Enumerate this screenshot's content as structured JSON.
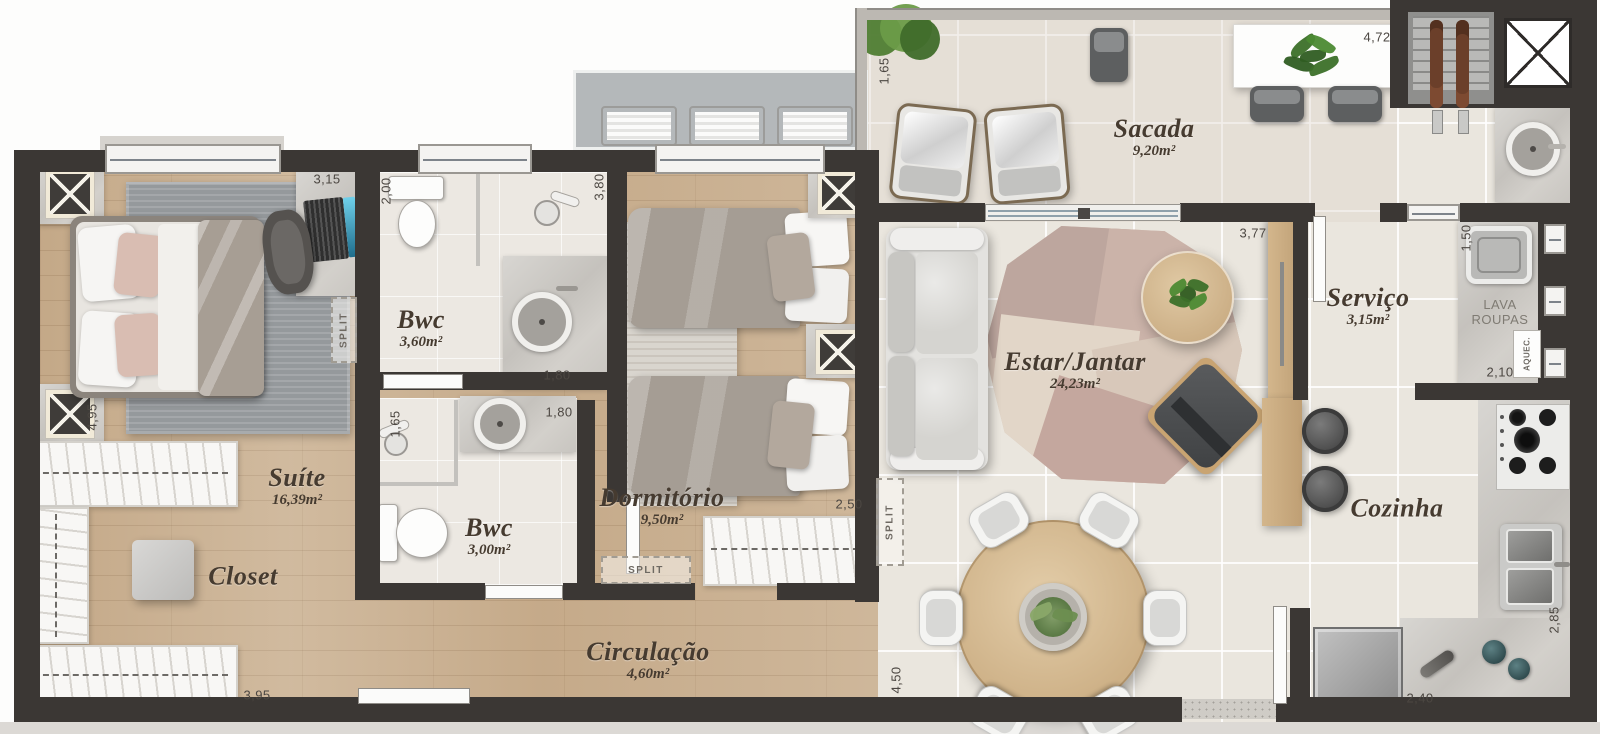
{
  "type": "floor_plan",
  "plan": {
    "rooms": [
      {
        "id": "suite",
        "name": "Suíte",
        "area": "16,39m²",
        "x": 297,
        "y": 487
      },
      {
        "id": "closet",
        "name": "Closet",
        "area": "",
        "x": 243,
        "y": 577
      },
      {
        "id": "bwc-suite",
        "name": "Bwc",
        "area": "3,60m²",
        "x": 421,
        "y": 329
      },
      {
        "id": "bwc-social",
        "name": "Bwc",
        "area": "3,00m²",
        "x": 489,
        "y": 537
      },
      {
        "id": "dormitorio",
        "name": "Dormitório",
        "area": "9,50m²",
        "x": 662,
        "y": 507
      },
      {
        "id": "circulacao",
        "name": "Circulação",
        "area": "4,60m²",
        "x": 648,
        "y": 661
      },
      {
        "id": "sacada",
        "name": "Sacada",
        "area": "9,20m²",
        "x": 1154,
        "y": 138
      },
      {
        "id": "estar-jantar",
        "name": "Estar/Jantar",
        "area": "24,23m²",
        "x": 1075,
        "y": 371
      },
      {
        "id": "servico",
        "name": "Serviço",
        "area": "3,15m²",
        "x": 1368,
        "y": 307
      },
      {
        "id": "cozinha",
        "name": "Cozinha",
        "area": "",
        "x": 1397,
        "y": 509
      }
    ],
    "dimensions": [
      {
        "text": "3,15",
        "x": 327,
        "y": 179,
        "rot": 0
      },
      {
        "text": "2,00",
        "x": 386,
        "y": 191,
        "rot": -90
      },
      {
        "text": "3,80",
        "x": 599,
        "y": 187,
        "rot": -90
      },
      {
        "text": "1,65",
        "x": 884,
        "y": 71,
        "rot": -90
      },
      {
        "text": "4,72",
        "x": 1377,
        "y": 37,
        "rot": 0
      },
      {
        "text": "4,95",
        "x": 92,
        "y": 417,
        "rot": -90
      },
      {
        "text": "3,95",
        "x": 257,
        "y": 695,
        "rot": 0
      },
      {
        "text": "1,80",
        "x": 557,
        "y": 375,
        "rot": 0
      },
      {
        "text": "1,65",
        "x": 395,
        "y": 424,
        "rot": -90
      },
      {
        "text": "1,80",
        "x": 559,
        "y": 412,
        "rot": 0
      },
      {
        "text": "2,50",
        "x": 849,
        "y": 504,
        "rot": 0
      },
      {
        "text": "3,77",
        "x": 1253,
        "y": 233,
        "rot": 0
      },
      {
        "text": "1,50",
        "x": 1466,
        "y": 238,
        "rot": -90
      },
      {
        "text": "2,10",
        "x": 1500,
        "y": 372,
        "rot": 0
      },
      {
        "text": "2,85",
        "x": 1554,
        "y": 620,
        "rot": -90
      },
      {
        "text": "2,40",
        "x": 1420,
        "y": 698,
        "rot": 0
      },
      {
        "text": "4,50",
        "x": 896,
        "y": 680,
        "rot": -90
      }
    ],
    "annotations": {
      "split_label": "SPLIT",
      "split_units": [
        {
          "x": 331,
          "y": 297,
          "w": 26,
          "h": 66,
          "v": true
        },
        {
          "x": 601,
          "y": 556,
          "w": 90,
          "h": 28,
          "v": false
        },
        {
          "x": 876,
          "y": 478,
          "w": 28,
          "h": 88,
          "v": true
        }
      ],
      "laundry_lines": [
        "LAVA",
        "ROUPAS"
      ],
      "heater_label": "AQUEC."
    },
    "colors": {
      "wall": "#3b3734",
      "wood_floor": "#c9af8f",
      "tile_floor": "#eae6de",
      "label_text": "#463b30",
      "dimension_text": "#4c4742"
    }
  }
}
